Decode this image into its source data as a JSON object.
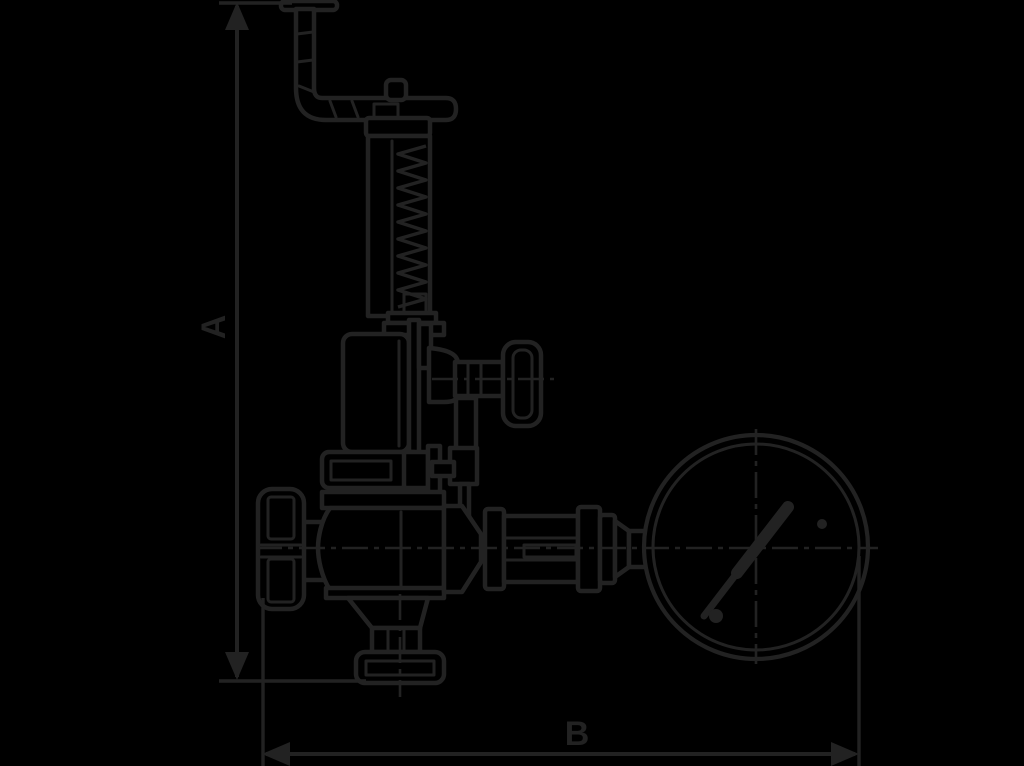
{
  "diagram": {
    "subject": "safety-relief-valve-with-pressure-gauge-outline-drawing",
    "style_vars": "--bg:#000000; --ink:#222222",
    "background_color": "#000000",
    "ink_color": "#222222",
    "dimension_labels": {
      "height": "A",
      "width": "B"
    },
    "parts": [
      "lever-handle",
      "adjusting-stem",
      "bonnet-cap",
      "spring-bonnet-tube",
      "spring-coil",
      "upper-housing",
      "side-knob",
      "knob-shaft",
      "bonnet-flange",
      "handwheel",
      "valve-body",
      "outlet-cone",
      "outlet-neck",
      "outlet-flange",
      "pipe-fittings",
      "reducer",
      "gauge-stub",
      "pressure-gauge",
      "gauge-needle",
      "centerlines"
    ]
  }
}
